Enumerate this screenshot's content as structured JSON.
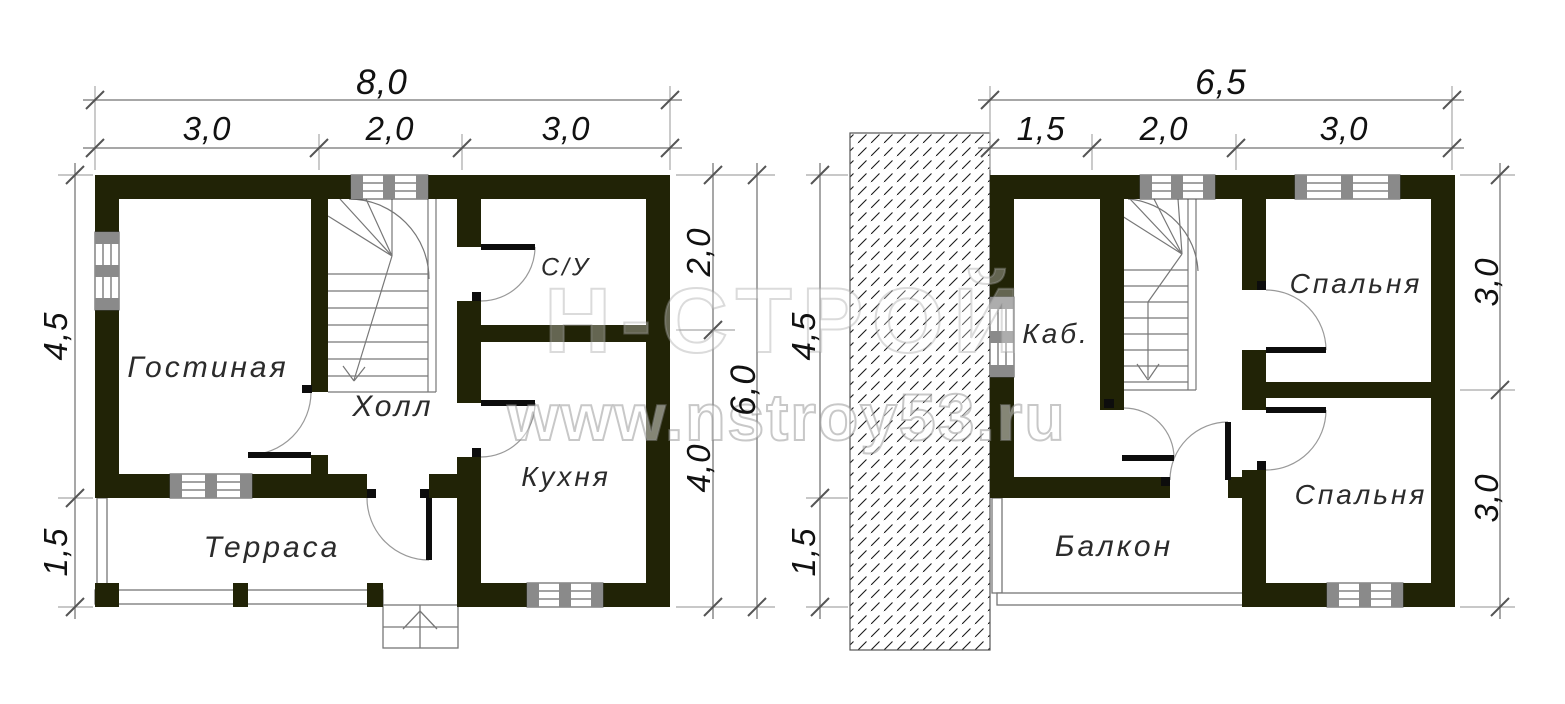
{
  "watermark": {
    "brand": "Н-СТРОЙ",
    "site": "www.nstroy53.ru"
  },
  "floor1": {
    "rooms": {
      "living_room": "Гостиная",
      "hall": "Холл",
      "bathroom": "С/У",
      "kitchen": "Кухня",
      "terrace": "Терраса"
    },
    "dimensions": {
      "top_total": "8,0",
      "top_segments": [
        "3,0",
        "2,0",
        "3,0"
      ],
      "left": [
        "4,5",
        "1,5"
      ],
      "right_segments": [
        "2,0",
        "4,0"
      ],
      "right_total": "6,0"
    }
  },
  "floor2": {
    "rooms": {
      "office": "Каб.",
      "bedroom_top": "Спальня",
      "bedroom_bottom": "Спальня",
      "balcony": "Балкон"
    },
    "dimensions": {
      "top_total": "6,5",
      "top_segments": [
        "1,5",
        "2,0",
        "3,0"
      ],
      "left": [
        "4,5",
        "1,5"
      ],
      "right_segments": [
        "3,0",
        "3,0"
      ]
    }
  }
}
